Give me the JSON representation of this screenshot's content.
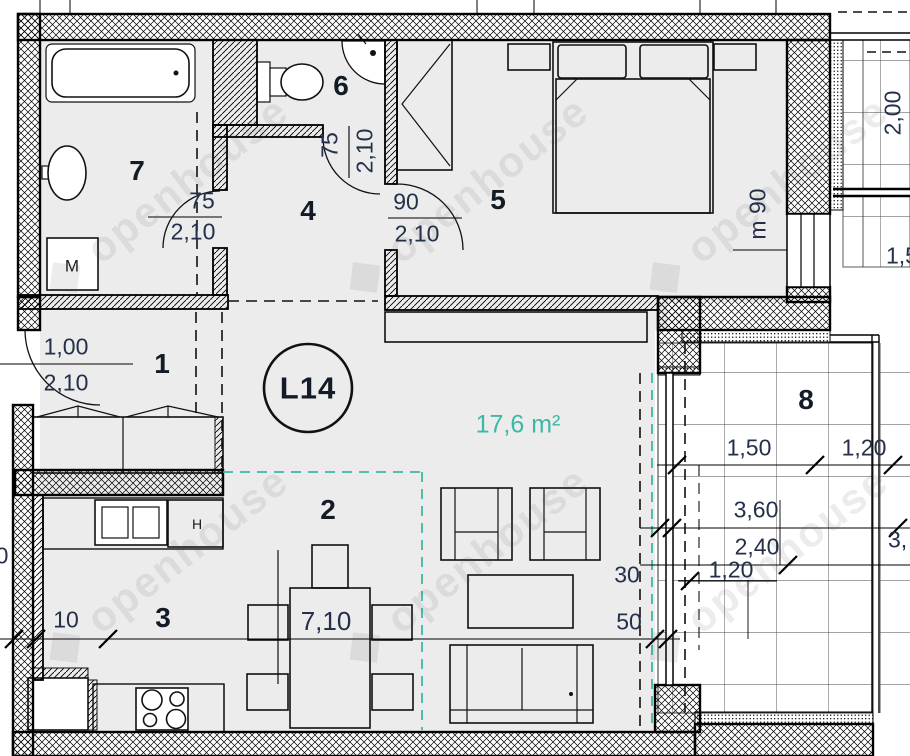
{
  "plan": {
    "unit_label": "L14",
    "living_area": "17,6 m²",
    "watermark": "openhouse",
    "accent_color": "#3cb8a6",
    "rooms": {
      "r1": "1",
      "r2": "2",
      "r3": "3",
      "r4": "4",
      "r5": "5",
      "r6": "6",
      "r7": "7",
      "r8": "8"
    },
    "doors": {
      "entrance_w": "1,00",
      "entrance_h": "2,10",
      "bath_w": "75",
      "bath_h": "2,10",
      "wc_w": "75",
      "wc_h": "2,10",
      "bedroom_w": "90",
      "bedroom_h": "2,10"
    },
    "dims": {
      "wall": "10",
      "total": "7,10",
      "d30": "30",
      "d50": "50",
      "b150": "1,50",
      "b120a": "1,20",
      "b360": "3,60",
      "b240": "2,40",
      "b120b": "1,20",
      "window_note": "m 90",
      "neighbor_v": "2,00",
      "partial_right_top": "1,5",
      "partial_right_bottom": "3,",
      "partial_left": "0"
    },
    "appliances": {
      "washer": "M",
      "fridge": "H"
    }
  }
}
